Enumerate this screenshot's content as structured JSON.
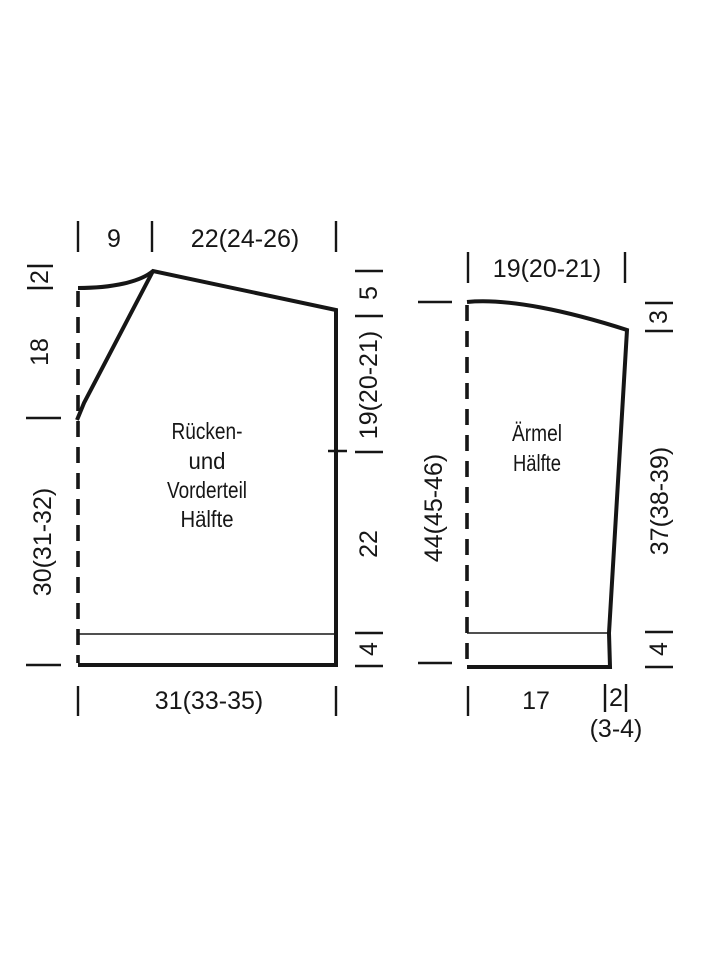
{
  "page": {
    "background": "#ffffff",
    "line_color": "#161616",
    "kind": "knitting pattern schematic"
  },
  "body_piece": {
    "title_lines": [
      "Rücken-",
      "und",
      "Vorderteil",
      "Hälfte"
    ],
    "top_neck_width": "9",
    "top_shoulder_width": "22(24-26)",
    "back_neck_depth": "2",
    "front_neck_depth": "18",
    "side_lower_length": "30(31-32)",
    "shoulder_drop": "5",
    "armhole_depth": "19(20-21)",
    "side_seam_length": "22",
    "rib_height": "4",
    "bottom_width": "31(33-35)"
  },
  "sleeve_piece": {
    "title_lines": [
      "Ärmel",
      "Hälfte"
    ],
    "top_width": "19(20-21)",
    "cap_drop": "3",
    "center_length": "44(45-46)",
    "side_length": "37(38-39)",
    "rib_height": "4",
    "bottom_width": "17",
    "widening": "2",
    "widening_sizes": "(3-4)"
  }
}
